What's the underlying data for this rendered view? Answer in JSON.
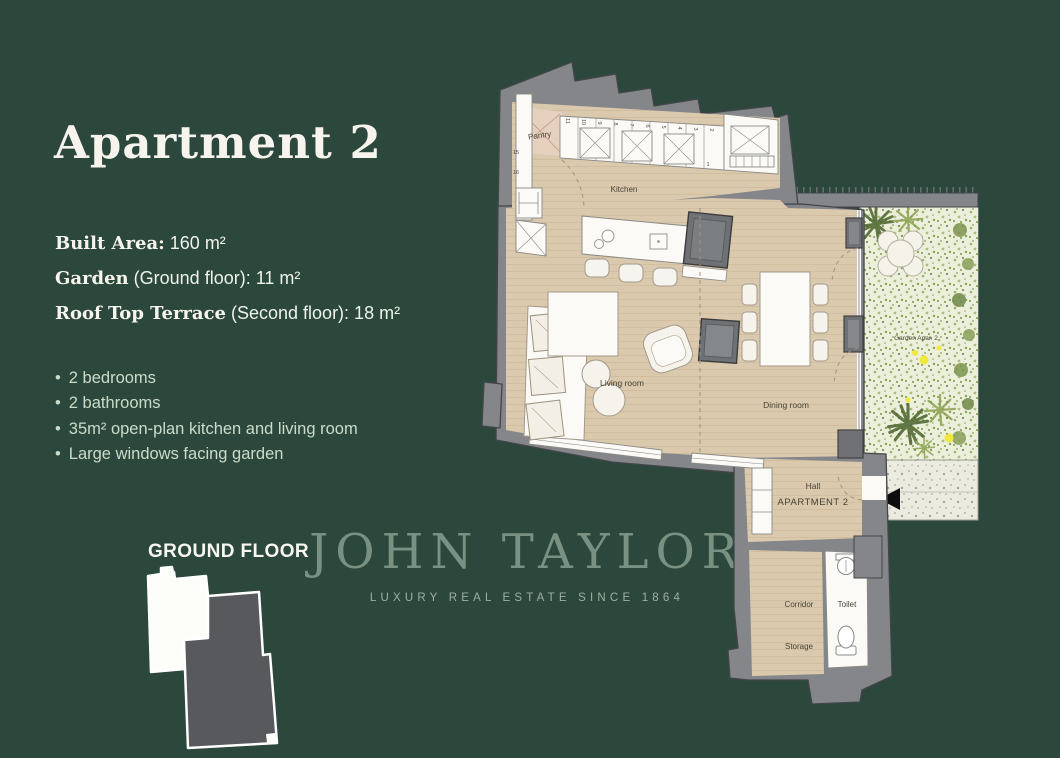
{
  "page": {
    "background_color": "#2c483c"
  },
  "title": "Apartment 2",
  "specs": [
    {
      "label": "Built Area:",
      "rest": " 160 m²"
    },
    {
      "label": "Garden",
      "rest": " (Ground floor): 11 m²"
    },
    {
      "label": "Roof Top Terrace",
      "rest": " (Second floor): 18 m²"
    }
  ],
  "features": [
    "2 bedrooms",
    "2 bathrooms",
    "35m² open-plan kitchen and living room",
    "Large windows facing garden"
  ],
  "key_plan": {
    "title": "GROUND FLOOR"
  },
  "watermark": {
    "brand": "JOHN TAYLOR",
    "tagline": "LUXURY REAL ESTATE SINCE 1864"
  },
  "floor_plan": {
    "labels": {
      "pantry": "Pantry",
      "kitchen": "Kitchen",
      "living_room": "Living room",
      "dining_room": "Dining room",
      "hall": "Hall",
      "apartment": "APARTMENT 2",
      "corridor": "Corridor",
      "toilet": "Toilet",
      "storage": "Storage",
      "garden": "Garden Apar. 2"
    },
    "cabinet_numbers": [
      "16",
      "15",
      "11",
      "10",
      "9",
      "8",
      "7",
      "6",
      "5",
      "4",
      "3",
      "2",
      "1"
    ],
    "colors": {
      "wall": "#84868a",
      "floor": "#dbc9ae",
      "garden_base": "#ebefdb",
      "accent_yellow": "#f0e93a"
    }
  }
}
